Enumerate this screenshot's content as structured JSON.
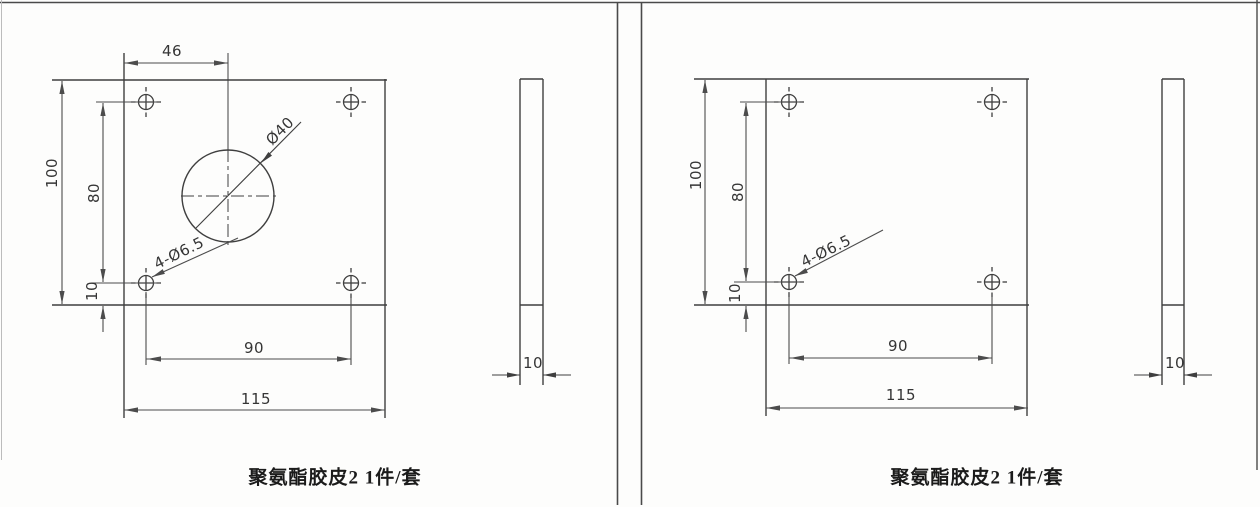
{
  "drawing": {
    "left": {
      "caption": "聚氨酯胶皮2 1件/套",
      "front": {
        "dim_top_width": "46",
        "dim_height": "100",
        "dim_hole_span_v": "80",
        "dim_hole_bottom": "10",
        "dim_hole_span_h": "90",
        "dim_width": "115",
        "center_hole": "Ø40",
        "corner_holes": "4-Ø6.5"
      },
      "side": {
        "thickness": "10"
      }
    },
    "right": {
      "caption": "聚氨酯胶皮2 1件/套",
      "front": {
        "dim_height": "100",
        "dim_hole_span_v": "80",
        "dim_hole_bottom": "10",
        "dim_hole_span_h": "90",
        "dim_width": "115",
        "corner_holes": "4-Ø6.5"
      },
      "side": {
        "thickness": "10"
      }
    },
    "colors": {
      "line": "#3f3f3f",
      "dim": "#4c4c4c",
      "paper": "#fdfdfc"
    }
  }
}
